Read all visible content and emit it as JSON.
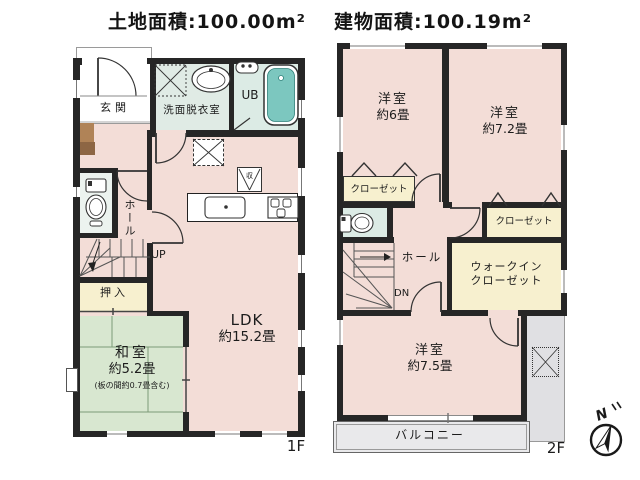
{
  "header": {
    "land_area": "土地面積:100.00m²",
    "building_area": "建物面積:100.19m²"
  },
  "floor1": {
    "label": "1F",
    "entrance": "玄関",
    "washroom": "洗面脱衣室",
    "bath": "UB",
    "hall": "ホール",
    "up": "UP",
    "closet": "押入",
    "japanese_room": {
      "name": "和室",
      "area": "約5.2畳",
      "note": "(板の間約0.7畳含む)"
    },
    "ldk": {
      "name": "LDK",
      "area": "約15.2畳"
    },
    "floor_storage": "収"
  },
  "floor2": {
    "label": "2F",
    "bedroom6": {
      "name": "洋室",
      "area": "約6畳"
    },
    "bedroom72": {
      "name": "洋室",
      "area": "約7.2畳"
    },
    "bedroom75": {
      "name": "洋室",
      "area": "約7.5畳"
    },
    "closet_left": "クローゼット",
    "closet_right": "クローゼット",
    "walkin": {
      "line1": "ウォークイン",
      "line2": "クローゼット"
    },
    "hall": "ホール",
    "down": "DN",
    "balcony": "バルコニー"
  },
  "compass": {
    "north": "N"
  },
  "colors": {
    "wall": "#262626",
    "room_pink": "#f3ddd7",
    "tatami_green": "#d8e7d0",
    "closet_cream": "#f7f0cf",
    "wet_mint": "#e0ebe5",
    "tub_teal": "#7cc7bf",
    "balcony_gray": "#e9e9eb",
    "roof_gray": "#e0e0e3",
    "cabinet_brown": "#b08357"
  }
}
